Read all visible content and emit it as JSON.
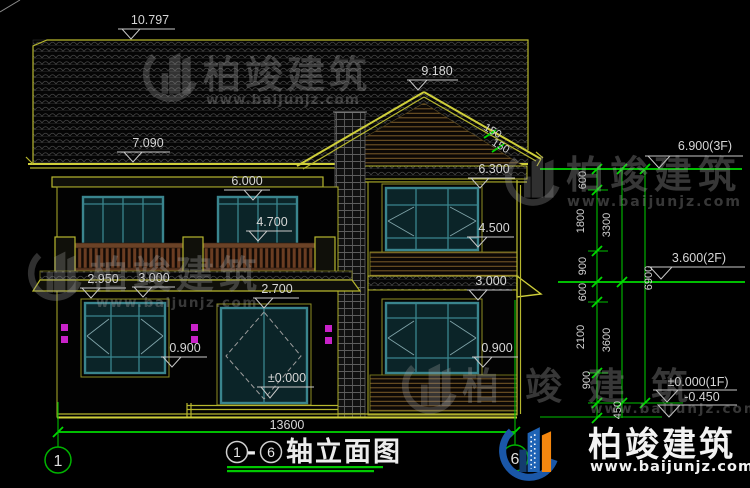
{
  "drawing": {
    "title": {
      "axis_from": "1",
      "sep": "-",
      "axis_to": "6",
      "text": "轴立面图"
    },
    "overall_width": "13600"
  },
  "markers": {
    "ridge": "10.797",
    "main_eave": "7.090",
    "gable_peak": "9.180",
    "win2f_head": "6.000",
    "right_eave": "6.300",
    "right_win2f_head": "4.500",
    "railing_top": "4.700",
    "porch_eave_left": "2.950",
    "porch_eave": "3.000",
    "door_head": "2.700",
    "right_floor2": "3.000",
    "sill_left": "0.900",
    "sill_right": "0.900",
    "ground": "±0.000",
    "slope": "150"
  },
  "levels": {
    "f3": "6.900(3F)",
    "f2": "3.600(2F)",
    "f1": "±0.000(1F)",
    "base": "-0.450"
  },
  "chain": {
    "seg1": "600",
    "seg2": "1800",
    "seg3": "900",
    "seg4": "600",
    "seg5": "2100",
    "seg6": "900",
    "seg7": "450",
    "sub1": "3300",
    "sub2": "3600",
    "total": "6900"
  },
  "axes": {
    "left": "1",
    "right": "6"
  },
  "brand": {
    "name": "柏竣建筑",
    "url": "www.baijunjz.com"
  },
  "colors": {
    "background": "#000000",
    "cad_yellow": "#b7b72e",
    "dimension_green": "#00bf00",
    "window_teal": "#3a858e",
    "lamp_magenta": "#c822c8",
    "brand_blue": "#1f63b5",
    "brand_orange": "#f5870f"
  }
}
